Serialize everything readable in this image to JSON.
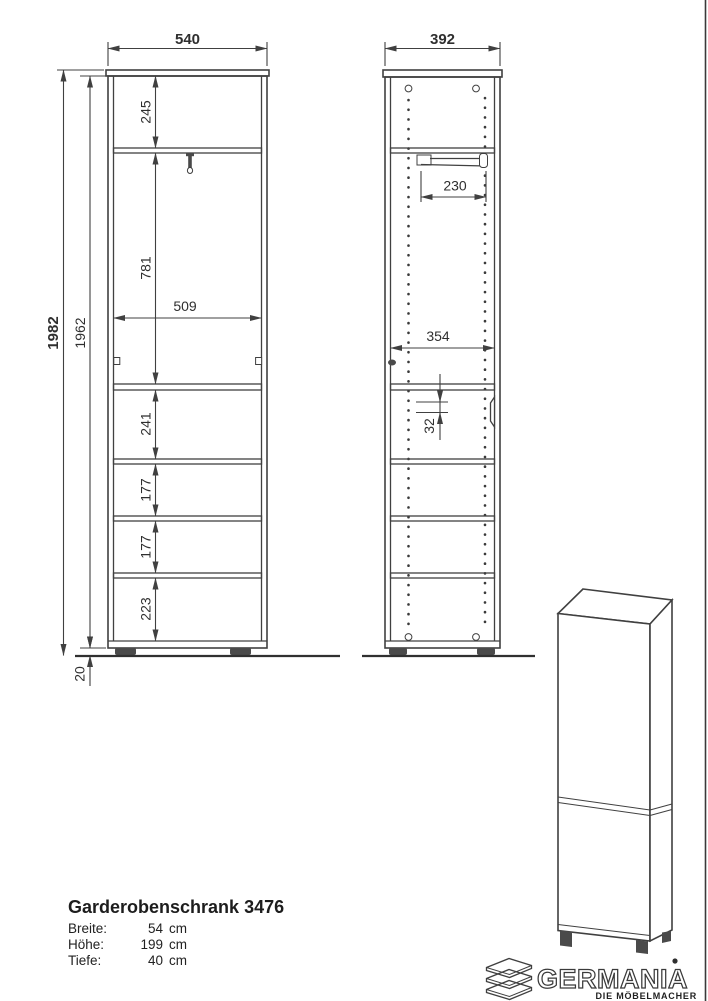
{
  "drawing": {
    "front_view": {
      "width": "540",
      "overall_height": "1982",
      "carcass_height": "1962",
      "section_top": "245",
      "section_hanging": "781",
      "inner_width": "509",
      "section_3": "241",
      "section_4": "177",
      "section_5": "177",
      "section_6": "223",
      "plinth_height": "20"
    },
    "side_view": {
      "depth": "392",
      "rail_length": "230",
      "inner_depth": "354",
      "hole_pitch": "32"
    }
  },
  "title_block": {
    "title": "Garderobenschrank 3476",
    "specs": [
      {
        "label": "Breite:",
        "value": "54",
        "unit": "cm"
      },
      {
        "label": "Höhe:",
        "value": "199",
        "unit": "cm"
      },
      {
        "label": "Tiefe:",
        "value": "40",
        "unit": "cm"
      }
    ]
  },
  "brand": {
    "name": "GERMANIA",
    "tagline": "DIE MÖBELMACHER"
  },
  "colors": {
    "line": "#404040",
    "text": "#2f2f2f",
    "background": "#ffffff",
    "feet": "#4a4a4a"
  }
}
